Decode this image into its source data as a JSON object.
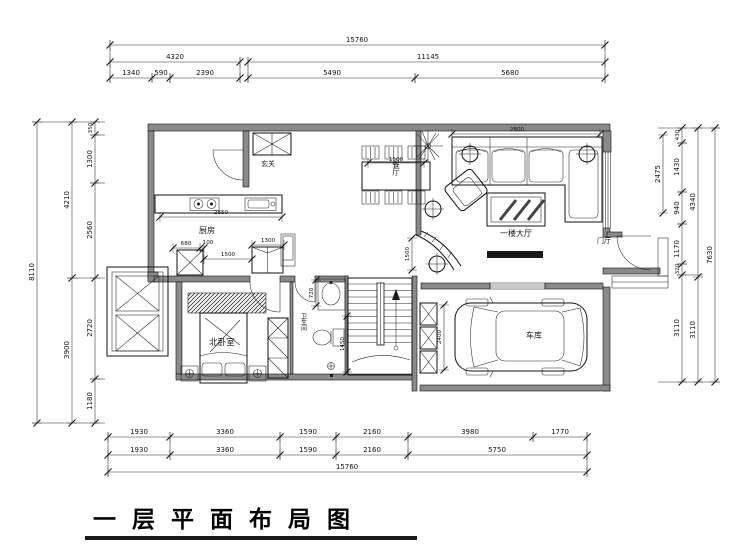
{
  "title": "一 层 平 面 布 局 图",
  "rooms": {
    "entry": "玄关",
    "kitchen": "厨房",
    "dining": "餐厅",
    "hall": "一楼大厅",
    "foyer": "门厅",
    "bedroom": "北卧室",
    "bathroom": "卫生间",
    "garage": "车库"
  },
  "dims": {
    "top": {
      "total": "15760",
      "mid": [
        "4320",
        "11145"
      ],
      "inner": [
        "1340",
        "590",
        "2390",
        "5490",
        "5680"
      ]
    },
    "bottom": {
      "row1": [
        "1930",
        "3360",
        "1590",
        "2160",
        "3980",
        "1770"
      ],
      "row2": [
        "1930",
        "3360",
        "1590",
        "2160",
        "5750"
      ],
      "total": "15760"
    },
    "left": {
      "outer": "8110",
      "mid": [
        "4210",
        "3900"
      ],
      "inner": [
        "350",
        "1300",
        "2560",
        "2720",
        "1180"
      ]
    },
    "right": {
      "outer": "7630",
      "mid": [
        "4340",
        "3110"
      ],
      "inner": [
        "430",
        "1430",
        "940",
        "1170",
        "320",
        "3110"
      ],
      "floating": "2475"
    },
    "interior": {
      "kitchen_counter": "2850",
      "closet": [
        "680",
        "100",
        "1500",
        "1300"
      ],
      "sofa": "2800",
      "dining_table": "1500",
      "stair_curve": "1500",
      "garage_side": "2400",
      "bath": [
        "720",
        "1450"
      ]
    }
  },
  "colors": {
    "line": "#111111",
    "wall_fill": "#8a8a8a"
  }
}
